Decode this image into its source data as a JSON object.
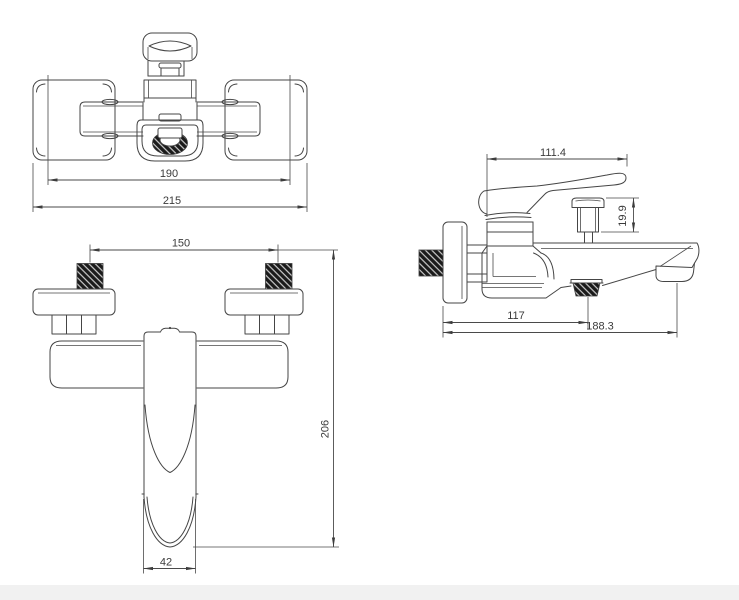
{
  "drawing": {
    "background": "#ffffff",
    "line_color": "#454545",
    "hatch_fill": "#1b1b1b",
    "views": {
      "plan": {
        "dims": [
          "190",
          "215"
        ]
      },
      "side": {
        "dims": [
          "111.4",
          "19.9",
          "117",
          "188.3"
        ]
      },
      "front": {
        "dims": [
          "150",
          "206",
          "42"
        ]
      }
    }
  }
}
